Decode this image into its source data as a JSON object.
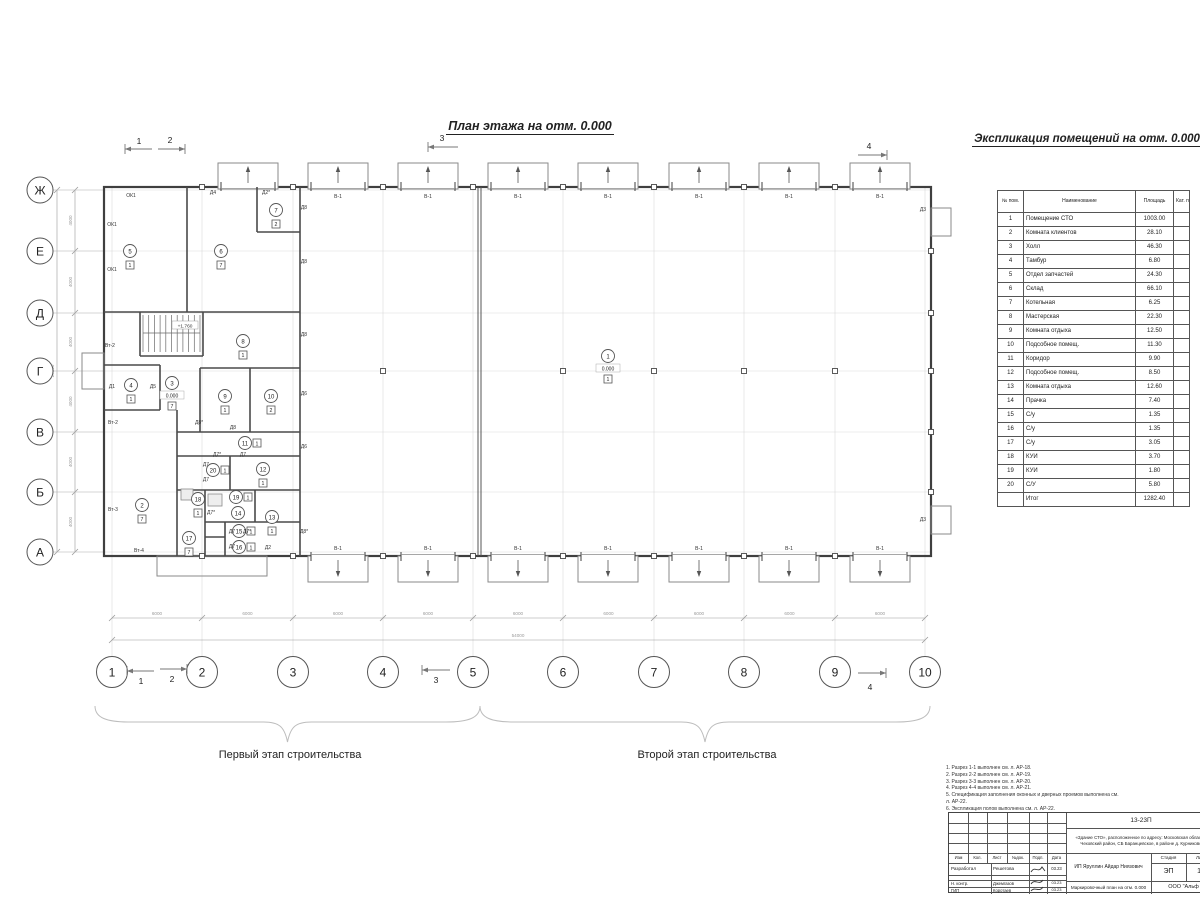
{
  "page": {
    "plan_title": "План этажа на отм. 0.000",
    "schedule_title": "Экспликация помещений на отм. 0.000",
    "stage1_label": "Первый этап строительства",
    "stage2_label": "Второй этап строительства"
  },
  "plan": {
    "axis_rows": [
      {
        "label": "Ж",
        "y": 190
      },
      {
        "label": "Е",
        "y": 251
      },
      {
        "label": "Д",
        "y": 313
      },
      {
        "label": "Г",
        "y": 371
      },
      {
        "label": "В",
        "y": 432
      },
      {
        "label": "Б",
        "y": 492
      },
      {
        "label": "А",
        "y": 552
      }
    ],
    "axis_cols": [
      {
        "label": "1",
        "x": 112
      },
      {
        "label": "2",
        "x": 202
      },
      {
        "label": "3",
        "x": 293
      },
      {
        "label": "4",
        "x": 383
      },
      {
        "label": "5",
        "x": 473
      },
      {
        "label": "6",
        "x": 563
      },
      {
        "label": "7",
        "x": 654
      },
      {
        "label": "8",
        "x": 744
      },
      {
        "label": "9",
        "x": 835
      },
      {
        "label": "10",
        "x": 925
      }
    ],
    "dim_bay": "6000",
    "dim_total": "54000",
    "dim_row": "4000",
    "dim_height": "24000",
    "gate_label": "В-1",
    "stair_elevation": "+1.760",
    "rooms": [
      {
        "n": "1",
        "x": 608,
        "y": 356,
        "sq": "1",
        "elev": "0.000"
      },
      {
        "n": "2",
        "x": 142,
        "y": 505,
        "sq": "7"
      },
      {
        "n": "3",
        "x": 172,
        "y": 383,
        "sq": "7",
        "elev": "0.000"
      },
      {
        "n": "4",
        "x": 131,
        "y": 385,
        "sq": "1"
      },
      {
        "n": "5",
        "x": 130,
        "y": 251,
        "sq": "1"
      },
      {
        "n": "6",
        "x": 221,
        "y": 251,
        "sq": "7"
      },
      {
        "n": "7",
        "x": 276,
        "y": 210,
        "sq": "2"
      },
      {
        "n": "8",
        "x": 243,
        "y": 341,
        "sq": "1"
      },
      {
        "n": "9",
        "x": 225,
        "y": 396,
        "sq": "1"
      },
      {
        "n": "10",
        "x": 271,
        "y": 396,
        "sq": "2"
      },
      {
        "n": "11",
        "x": 245,
        "y": 443,
        "sq": "1",
        "sqside": "right"
      },
      {
        "n": "12",
        "x": 263,
        "y": 469,
        "sq": "1"
      },
      {
        "n": "13",
        "x": 272,
        "y": 517,
        "sq": "1"
      },
      {
        "n": "14",
        "x": 238,
        "y": 513
      },
      {
        "n": "15",
        "x": 239,
        "y": 531,
        "sq": "1",
        "sqside": "right"
      },
      {
        "n": "16",
        "x": 239,
        "y": 547,
        "sq": "1",
        "sqside": "right"
      },
      {
        "n": "17",
        "x": 189,
        "y": 538,
        "sq": "7"
      },
      {
        "n": "18",
        "x": 198,
        "y": 499,
        "sq": "1"
      },
      {
        "n": "19",
        "x": 236,
        "y": 497,
        "sq": "1",
        "sqside": "right"
      },
      {
        "n": "20",
        "x": 213,
        "y": 470,
        "sq": "1",
        "sqside": "right"
      }
    ],
    "labels": [
      {
        "t": "ОК1",
        "x": 131,
        "y": 197
      },
      {
        "t": "ОК1",
        "x": 112,
        "y": 226
      },
      {
        "t": "ОК1",
        "x": 112,
        "y": 271
      },
      {
        "t": "Д4",
        "x": 213,
        "y": 194
      },
      {
        "t": "Д2*",
        "x": 266,
        "y": 194
      },
      {
        "t": "Д8",
        "x": 304,
        "y": 209
      },
      {
        "t": "Д8",
        "x": 304,
        "y": 263
      },
      {
        "t": "Д8",
        "x": 304,
        "y": 336
      },
      {
        "t": "Д6",
        "x": 304,
        "y": 395
      },
      {
        "t": "Д6",
        "x": 304,
        "y": 448
      },
      {
        "t": "Д8*",
        "x": 304,
        "y": 533
      },
      {
        "t": "Д3",
        "x": 923,
        "y": 211
      },
      {
        "t": "Д3",
        "x": 923,
        "y": 521
      },
      {
        "t": "Вт-2",
        "x": 110,
        "y": 347
      },
      {
        "t": "Вт-2",
        "x": 113,
        "y": 424
      },
      {
        "t": "Вт-3",
        "x": 113,
        "y": 511
      },
      {
        "t": "Вт-4",
        "x": 139,
        "y": 552
      },
      {
        "t": "Д1",
        "x": 112,
        "y": 388
      },
      {
        "t": "Д5",
        "x": 153,
        "y": 388
      },
      {
        "t": "Д8*",
        "x": 199,
        "y": 424
      },
      {
        "t": "Д8",
        "x": 233,
        "y": 429
      },
      {
        "t": "Д7*",
        "x": 217,
        "y": 456
      },
      {
        "t": "Д7",
        "x": 243,
        "y": 456
      },
      {
        "t": "Д7",
        "x": 206,
        "y": 466
      },
      {
        "t": "Д7",
        "x": 206,
        "y": 481
      },
      {
        "t": "Д7*",
        "x": 211,
        "y": 514
      },
      {
        "t": "Д7",
        "x": 232,
        "y": 533
      },
      {
        "t": "Д7*",
        "x": 247,
        "y": 533
      },
      {
        "t": "Д7",
        "x": 232,
        "y": 548
      },
      {
        "t": "Д2",
        "x": 268,
        "y": 549
      }
    ],
    "sections": [
      {
        "label": "1",
        "x1": 125,
        "x2": 152,
        "y": 149,
        "dir": "left",
        "lx": 139,
        "ly": 144
      },
      {
        "label": "2",
        "x1": 158,
        "x2": 185,
        "y": 149,
        "dir": "right",
        "lx": 170,
        "ly": 143
      },
      {
        "label": "3",
        "x1": 428,
        "x2": 458,
        "y": 147,
        "dir": "left",
        "lx": 442,
        "ly": 141
      },
      {
        "label": "4",
        "x1": 858,
        "x2": 887,
        "y": 155,
        "dir": "right",
        "lx": 869,
        "ly": 149
      },
      {
        "label": "1",
        "x1": 127,
        "x2": 154,
        "y": 671,
        "dir": "left",
        "lx": 141,
        "ly": 684
      },
      {
        "label": "2",
        "x1": 160,
        "x2": 187,
        "y": 669,
        "dir": "right",
        "lx": 172,
        "ly": 682
      },
      {
        "label": "3",
        "x1": 422,
        "x2": 450,
        "y": 670,
        "dir": "left",
        "lx": 436,
        "ly": 683
      },
      {
        "label": "4",
        "x1": 858,
        "x2": 886,
        "y": 673,
        "dir": "right",
        "lx": 870,
        "ly": 690
      }
    ]
  },
  "schedule": {
    "headers": [
      "№ пом.",
      "Наименование",
      "Площадь",
      "Кат. пом."
    ],
    "rows": [
      [
        "1",
        "Помещение СТО",
        "1003.00"
      ],
      [
        "2",
        "Комната клиентов",
        "28.10"
      ],
      [
        "3",
        "Холл",
        "46.30"
      ],
      [
        "4",
        "Тамбур",
        "6.80"
      ],
      [
        "5",
        "Отдел запчастей",
        "24.30"
      ],
      [
        "6",
        "Склад",
        "66.10"
      ],
      [
        "7",
        "Котельная",
        "6.25"
      ],
      [
        "8",
        "Мастерская",
        "22.30"
      ],
      [
        "9",
        "Комната отдыха",
        "12.50"
      ],
      [
        "10",
        "Подсобное помещ.",
        "11.30"
      ],
      [
        "11",
        "Коридор",
        "9.90"
      ],
      [
        "12",
        "Подсобное помещ.",
        "8.50"
      ],
      [
        "13",
        "Комната отдыха",
        "12.60"
      ],
      [
        "14",
        "Прачка",
        "7.40"
      ],
      [
        "15",
        "С/у",
        "1.35"
      ],
      [
        "16",
        "С/у",
        "1.35"
      ],
      [
        "17",
        "С/у",
        "3.05"
      ],
      [
        "18",
        "КУИ",
        "3.70"
      ],
      [
        "19",
        "КУИ",
        "1.80"
      ],
      [
        "20",
        "С/У",
        "5.80"
      ]
    ],
    "total_label": "Итог",
    "total_value": "1282.40"
  },
  "notes": [
    "1. Разрез 1-1 выполнен см. л. АР-18.",
    "2. Разрез 2-2 выполнен см. л. АР-19.",
    "3. Разрез 3-3 выполнен см. л. АР-20.",
    "4. Разрез 4-4 выполнен см. л. АР-21.",
    "5. Спецификация заполнения оконных и дверных проемов выполнена см. л. АР-22.",
    "6. Экспликация полов выполнена см. л. АР-22."
  ],
  "titleblock": {
    "code": "13-23П",
    "object": "«Здание СТО», расположенное по адресу: Московская область, Чеховский район, СБ Баранцевское, в районе д. Курниково",
    "cols": [
      "Изм",
      "Кол.",
      "Лист",
      "№док.",
      "Подп.",
      "Дата"
    ],
    "rows": [
      {
        "role": "Разработал",
        "name": "Решетова",
        "date": "03.23"
      },
      {
        "role": "Н. контр.",
        "name": "Джемгазов",
        "date": "03.23"
      },
      {
        "role": "ГИП",
        "name": "Коротаев",
        "date": "03.23"
      }
    ],
    "client": "ИП Яруллин Айдар Ниязович",
    "stage_label": "Стадия",
    "sheet_label": "Лист",
    "stage": "ЭП",
    "sheet": "15",
    "doc_title": "Маркировочный план на отм. 0.000",
    "company": "ООО \"Альф"
  }
}
